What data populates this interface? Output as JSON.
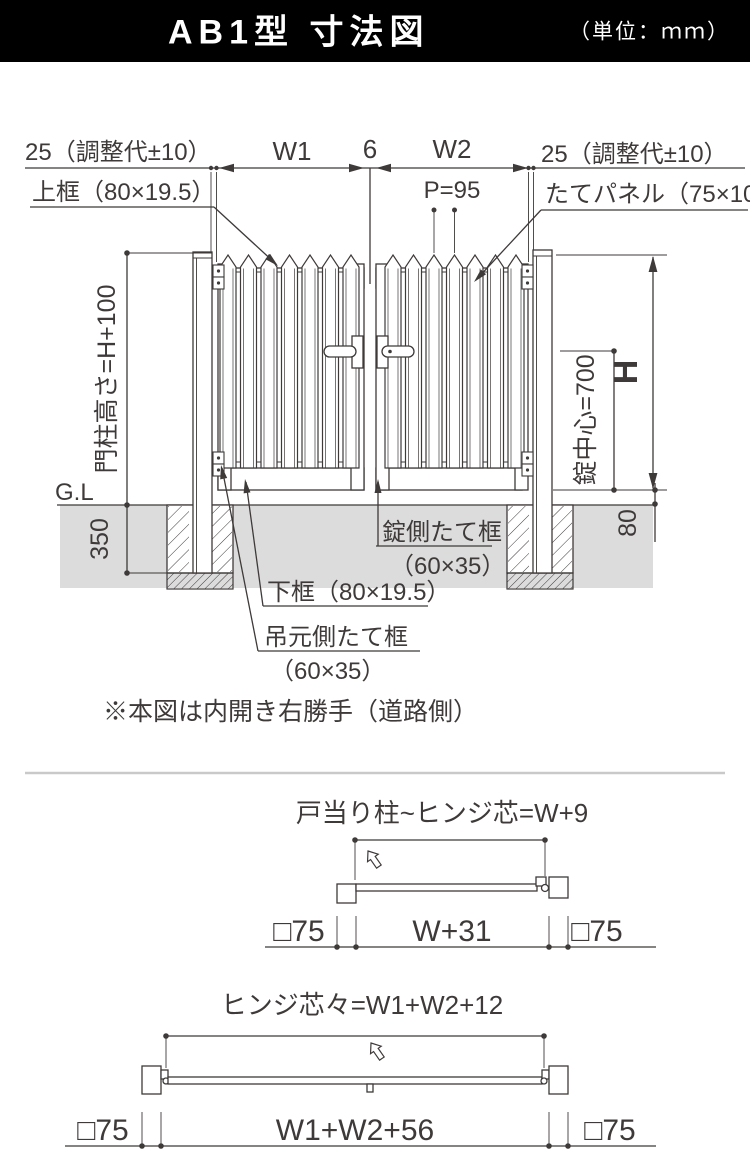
{
  "header": {
    "title": "AB1型 寸法図",
    "unit": "（単位：ｍｍ）"
  },
  "main": {
    "dim_adjust_left": "25（調整代±10）",
    "dim_w1": "W1",
    "dim_gap6": "6",
    "dim_w2": "W2",
    "dim_adjust_right": "25（調整代±10）",
    "label_top_rail": "上框（80×19.5）",
    "dim_pitch": "P=95",
    "label_panel": "たてパネル（75×10）",
    "dim_post_height": "門柱高さ=H+100",
    "label_gl": "G.L",
    "dim_350": "350",
    "dim_h": "H",
    "dim_lock_center": "錠中心=700",
    "dim_80": "80",
    "label_lock_stile": "錠側たて框",
    "label_lock_stile_size": "（60×35）",
    "label_bottom_rail": "下框（80×19.5）",
    "label_hinge_stile": "吊元側たて框",
    "label_hinge_stile_size": "（60×35）",
    "note": "※本図は内開き右勝手（道路側）"
  },
  "plan_a": {
    "title": "戸当り柱~ヒンジ芯=W+9",
    "left_post": "□75",
    "span": "W+31",
    "right_post": "□75"
  },
  "plan_b": {
    "title": "ヒンジ芯々=W1+W2+12",
    "left_post": "□75",
    "span": "W1+W2+56",
    "right_post": "□75"
  },
  "colors": {
    "line": "#3e3a39",
    "ground": "#dcdcdc",
    "header_bg": "#000000",
    "header_text": "#ffffff",
    "separator": "#c9c9c9"
  }
}
